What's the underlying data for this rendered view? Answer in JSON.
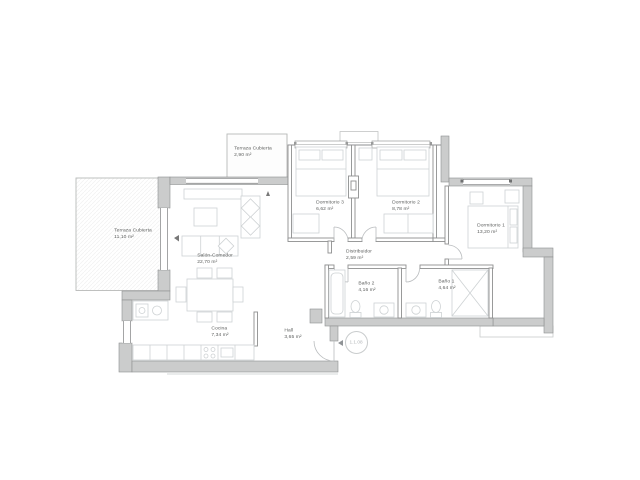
{
  "plan": {
    "rooms": [
      {
        "id": "terraza-cubierta-top",
        "name": "Terraza Cubierta",
        "area": "2,90 m²"
      },
      {
        "id": "terraza-cubierta-left",
        "name": "Terraza Cubierta",
        "area": "11,10 m²"
      },
      {
        "id": "dormitorio-3",
        "name": "Dormitorio 3",
        "area": "6,62 m²"
      },
      {
        "id": "dormitorio-2",
        "name": "Dormitorio 2",
        "area": "8,78 m²"
      },
      {
        "id": "dormitorio-1",
        "name": "Dormitorio 1",
        "area": "13,20 m²"
      },
      {
        "id": "salon-comedor",
        "name": "Salón-Comedor",
        "area": "22,70 m²"
      },
      {
        "id": "distribuidor",
        "name": "Distribuidor",
        "area": "2,59 m²"
      },
      {
        "id": "bano-2",
        "name": "Baño 2",
        "area": "4,16 m²"
      },
      {
        "id": "bano-1",
        "name": "Baño 1",
        "area": "4,64 m²"
      },
      {
        "id": "cocina",
        "name": "Cocina",
        "area": "7,34 m²"
      },
      {
        "id": "hall",
        "name": "Hall",
        "area": "3,65 m²"
      }
    ],
    "entry": {
      "code": "1.1.08"
    },
    "colors": {
      "wall_fill": "#cbcccc",
      "wall_line": "#8e8f90",
      "terrace_line": "#b8bab9",
      "furniture_line": "#ced2d4",
      "door_arc": "#b9bcbe",
      "label_text": "#5c5e5d",
      "unit_marker": "#b2b6b8"
    }
  }
}
